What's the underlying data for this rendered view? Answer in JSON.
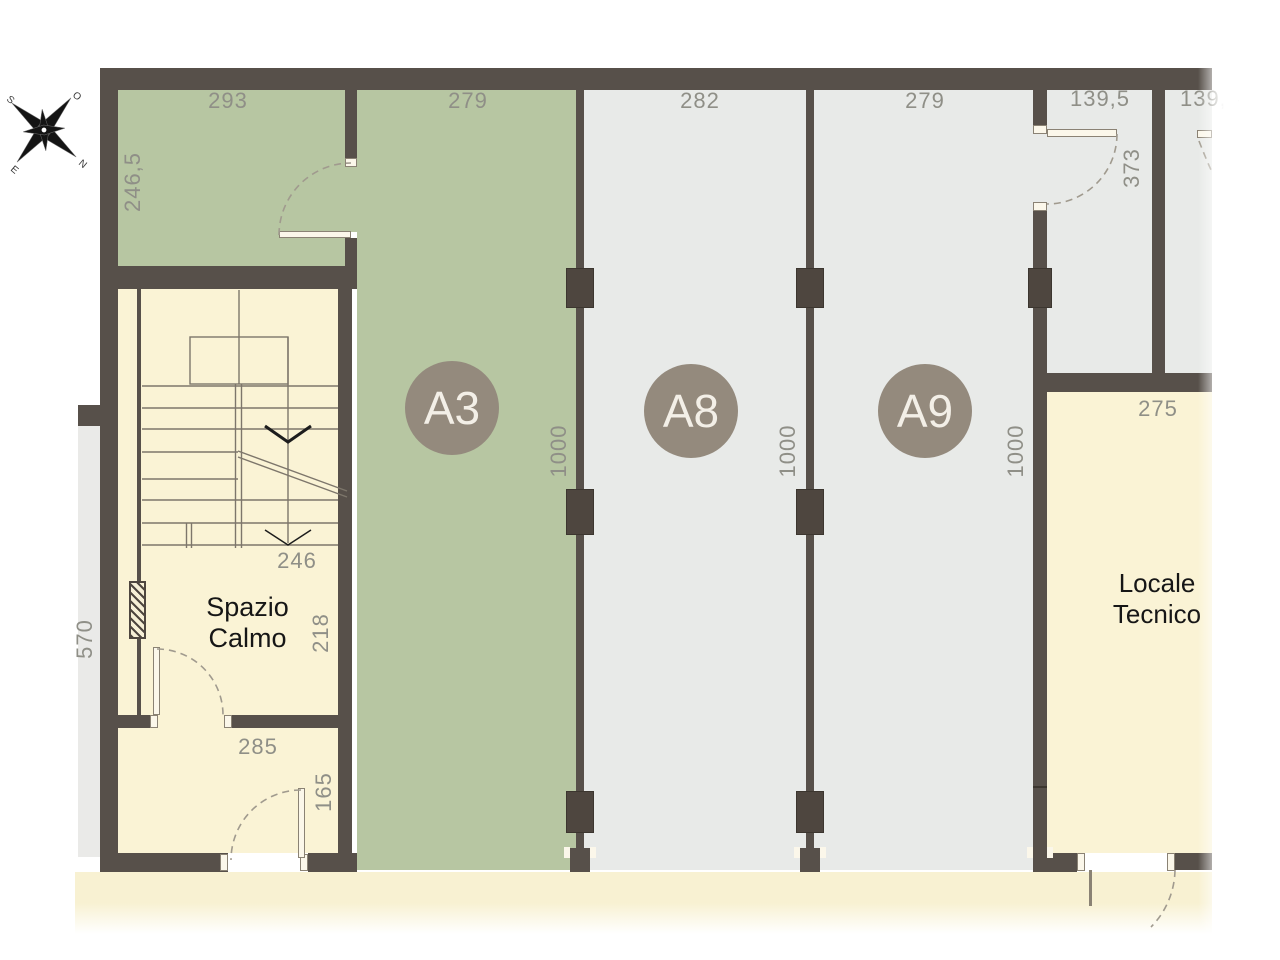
{
  "compass": {
    "o": "O",
    "n": "N",
    "e": "E",
    "s": "S"
  },
  "units": [
    {
      "id": "A3"
    },
    {
      "id": "A8"
    },
    {
      "id": "A9"
    }
  ],
  "rooms": {
    "spazio_calmo": "Spazio Calmo",
    "locale_tecnico": "Locale Tecnico"
  },
  "dims": {
    "nw_width": "293",
    "nw_height": "246,5",
    "a3_width": "279",
    "a8_width": "282",
    "a9_width": "279",
    "corridor_width": "139,5",
    "right_room_width": "139,5",
    "corridor_depth": "373",
    "depth_a3": "1000",
    "depth_a8": "1000",
    "depth_a9": "1000",
    "stair_width": "246",
    "spazio_depth": "218",
    "left_depth": "570",
    "vestibule_width": "285",
    "entry_width": "165",
    "locale_width": "275"
  }
}
